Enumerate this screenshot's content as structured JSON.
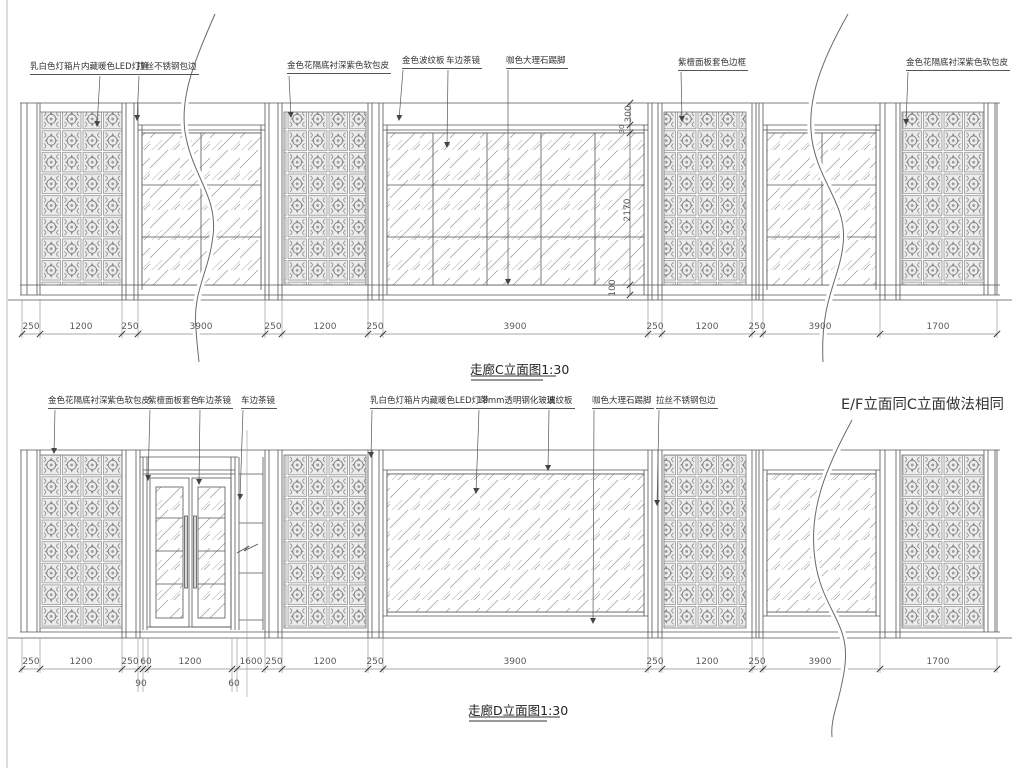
{
  "sheet": {
    "note_ef": "E/F立面同C立面做法相同"
  },
  "elevation_c": {
    "title": "走廊C立面图1:30",
    "callouts": [
      "乳白色灯箱片内藏暖色LED灯管",
      "拉丝不锈钢包边",
      "金色花隔底衬深紫色软包皮",
      "金色波纹板",
      "车边茶镜",
      "咖色大理石踢脚",
      "紫檀面板套色边框",
      "金色花隔底衬深紫色软包皮"
    ],
    "dims": [
      "250",
      "1200",
      "250",
      "3900",
      "250",
      "1200",
      "250",
      "3900",
      "250",
      "1200",
      "250",
      "3900",
      "1700"
    ],
    "vdims": [
      "300",
      "30",
      "2170",
      "100"
    ]
  },
  "elevation_d": {
    "title": "走廊D立面图1:30",
    "callouts": [
      "金色花隔底衬深紫色软包皮",
      "紫檀面板套色",
      "车边茶镜",
      "车边茶镜",
      "乳白色灯箱片内藏暖色LED灯带",
      "18mm透明钢化玻璃",
      "波纹板",
      "咖色大理石踢脚",
      "拉丝不锈钢包边"
    ],
    "dims": [
      "250",
      "1200",
      "250",
      "60",
      "1200",
      "1600",
      "250",
      "1200",
      "250",
      "3900",
      "250",
      "1200",
      "250",
      "3900",
      "1700"
    ],
    "dims_sub": [
      "90",
      "60"
    ]
  }
}
